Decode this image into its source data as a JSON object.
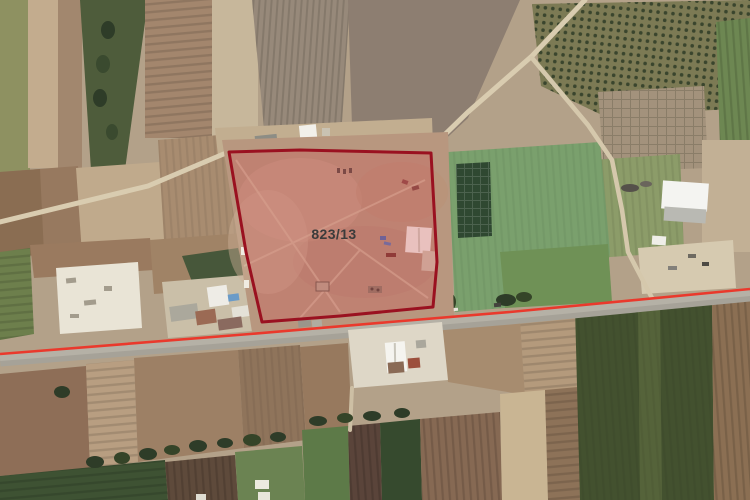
{
  "parcel": {
    "label": "823/13",
    "label_color": "#3b3b3b",
    "border_color": "#9a1120",
    "fill_color": "rgba(213,76,82,0.28)",
    "points": "229,152 300,150 431,153 437,262 433,307 340,316 262,322 246,252"
  },
  "highlight_line": {
    "color": "#ea392c",
    "points": "0,354 250,334 390,322 510,312 750,289"
  }
}
